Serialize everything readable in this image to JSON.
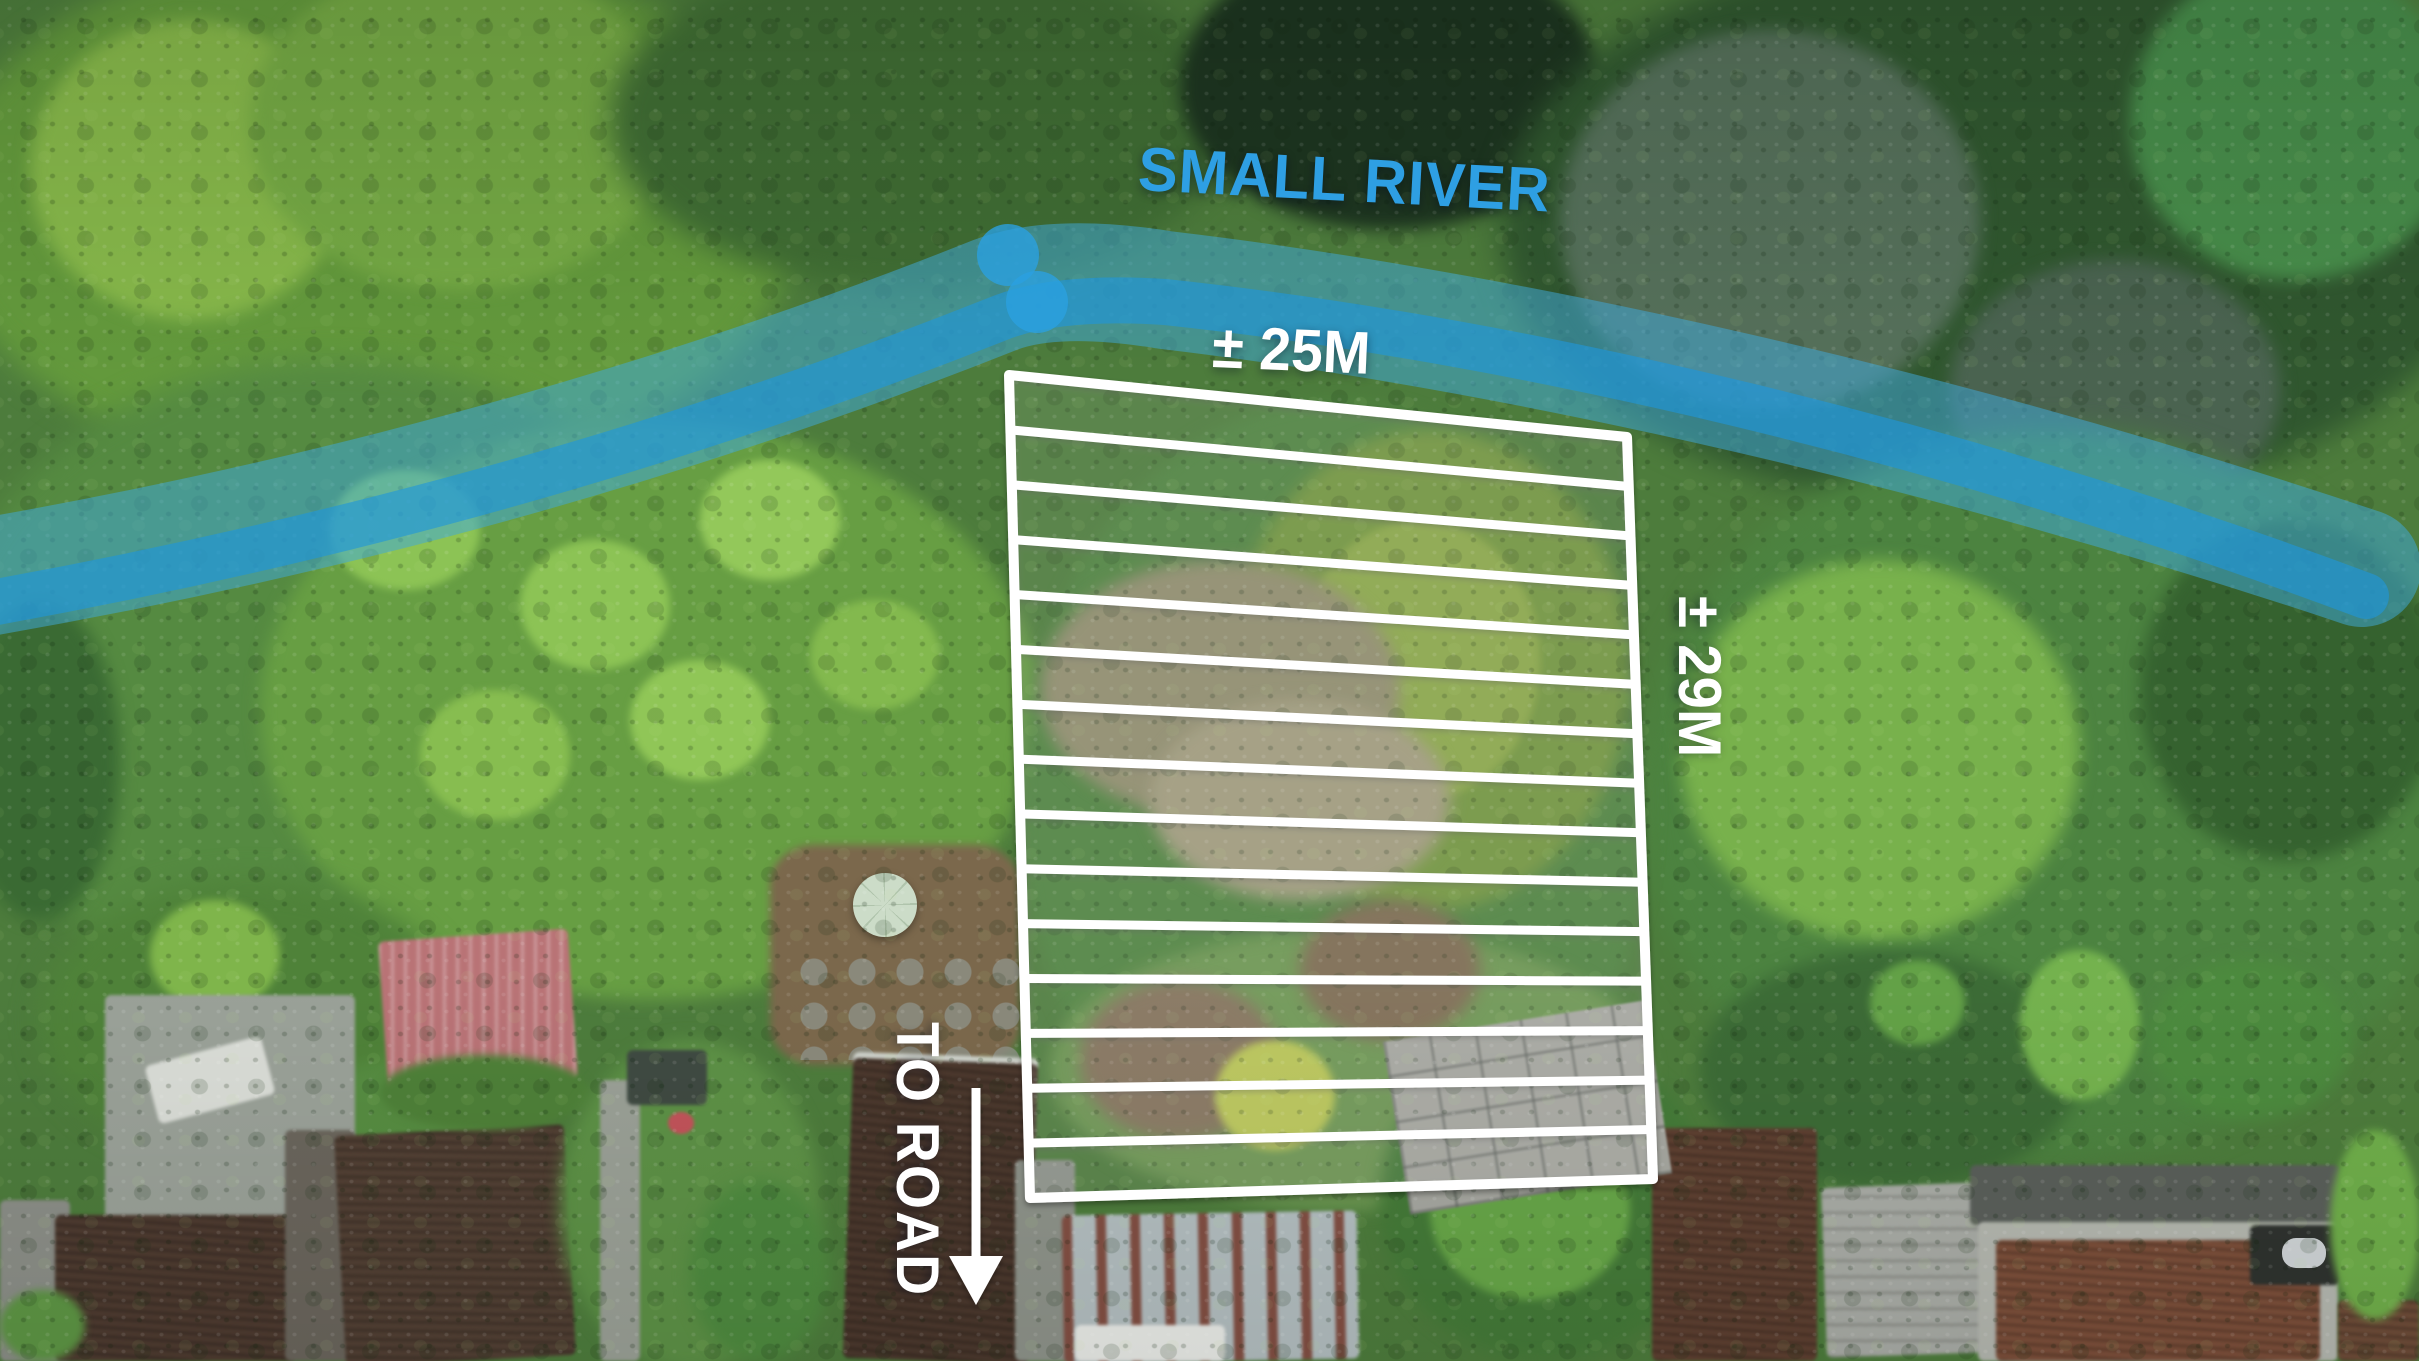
{
  "annotations": {
    "river_label": "SMALL RIVER",
    "plot_width_label": "± 25M",
    "plot_depth_label": "± 29M",
    "road_label": "TO ROAD"
  },
  "colors": {
    "river_label": "#2E9FE3",
    "river_band": "#3FA8DB",
    "river_band_dark": "#1E96DC",
    "river_marker": "#2AA0E0",
    "plot_outline": "#FFFFFF",
    "dimension_text": "#FFFFFF",
    "arrow": "#FFFFFF"
  },
  "plot_overlay": {
    "corners": {
      "top_left": [
        1009,
        375
      ],
      "top_right": [
        1627,
        437
      ],
      "bottom_right": [
        1653,
        1179
      ],
      "bottom_left": [
        1030,
        1198
      ]
    },
    "hatch_line_count": 14,
    "outline_stroke_width": 10,
    "hatch_stroke_width": 9
  },
  "river_markers": [
    {
      "cx": 1008,
      "cy": 255,
      "r": 31
    },
    {
      "cx": 1037,
      "cy": 302,
      "r": 31
    }
  ],
  "arrow": {
    "x": 976,
    "y_top": 1088,
    "y_bottom": 1262,
    "tip_y": 1305,
    "half_width": 27
  }
}
